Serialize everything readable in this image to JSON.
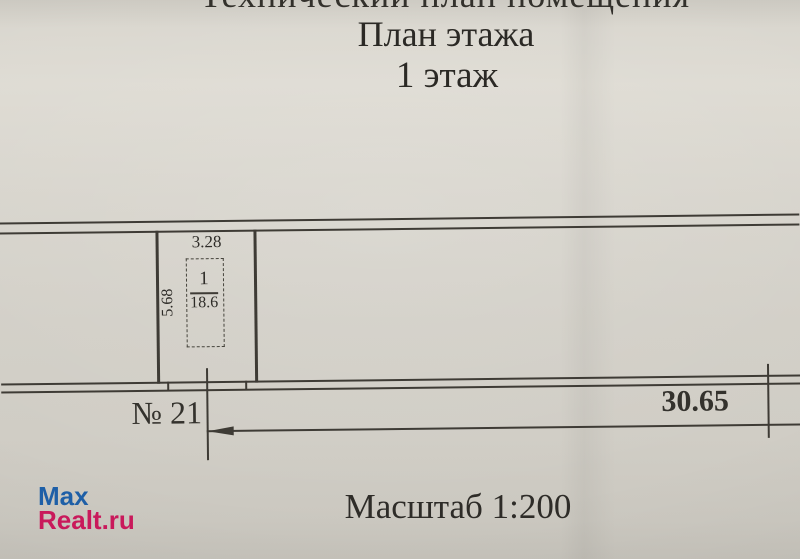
{
  "document": {
    "clipped_header": "Технический план помещения",
    "title": "План этажа",
    "floor": "1 этаж",
    "scale": "Масштаб 1:200"
  },
  "plan": {
    "room_number": "1",
    "room_area": "18.6",
    "dim_width": "3.28",
    "dim_height": "5.68",
    "dim_total_length": "30.65",
    "unit_label": "№ 21"
  },
  "watermark": {
    "line1": "Max",
    "line2": "Realt.ru",
    "line1_color": "#1e5fa7",
    "line2_color": "#c9195b"
  },
  "colors": {
    "paper": "#d5d2ca",
    "ink": "#3e3b35",
    "text": "#2b2925"
  }
}
